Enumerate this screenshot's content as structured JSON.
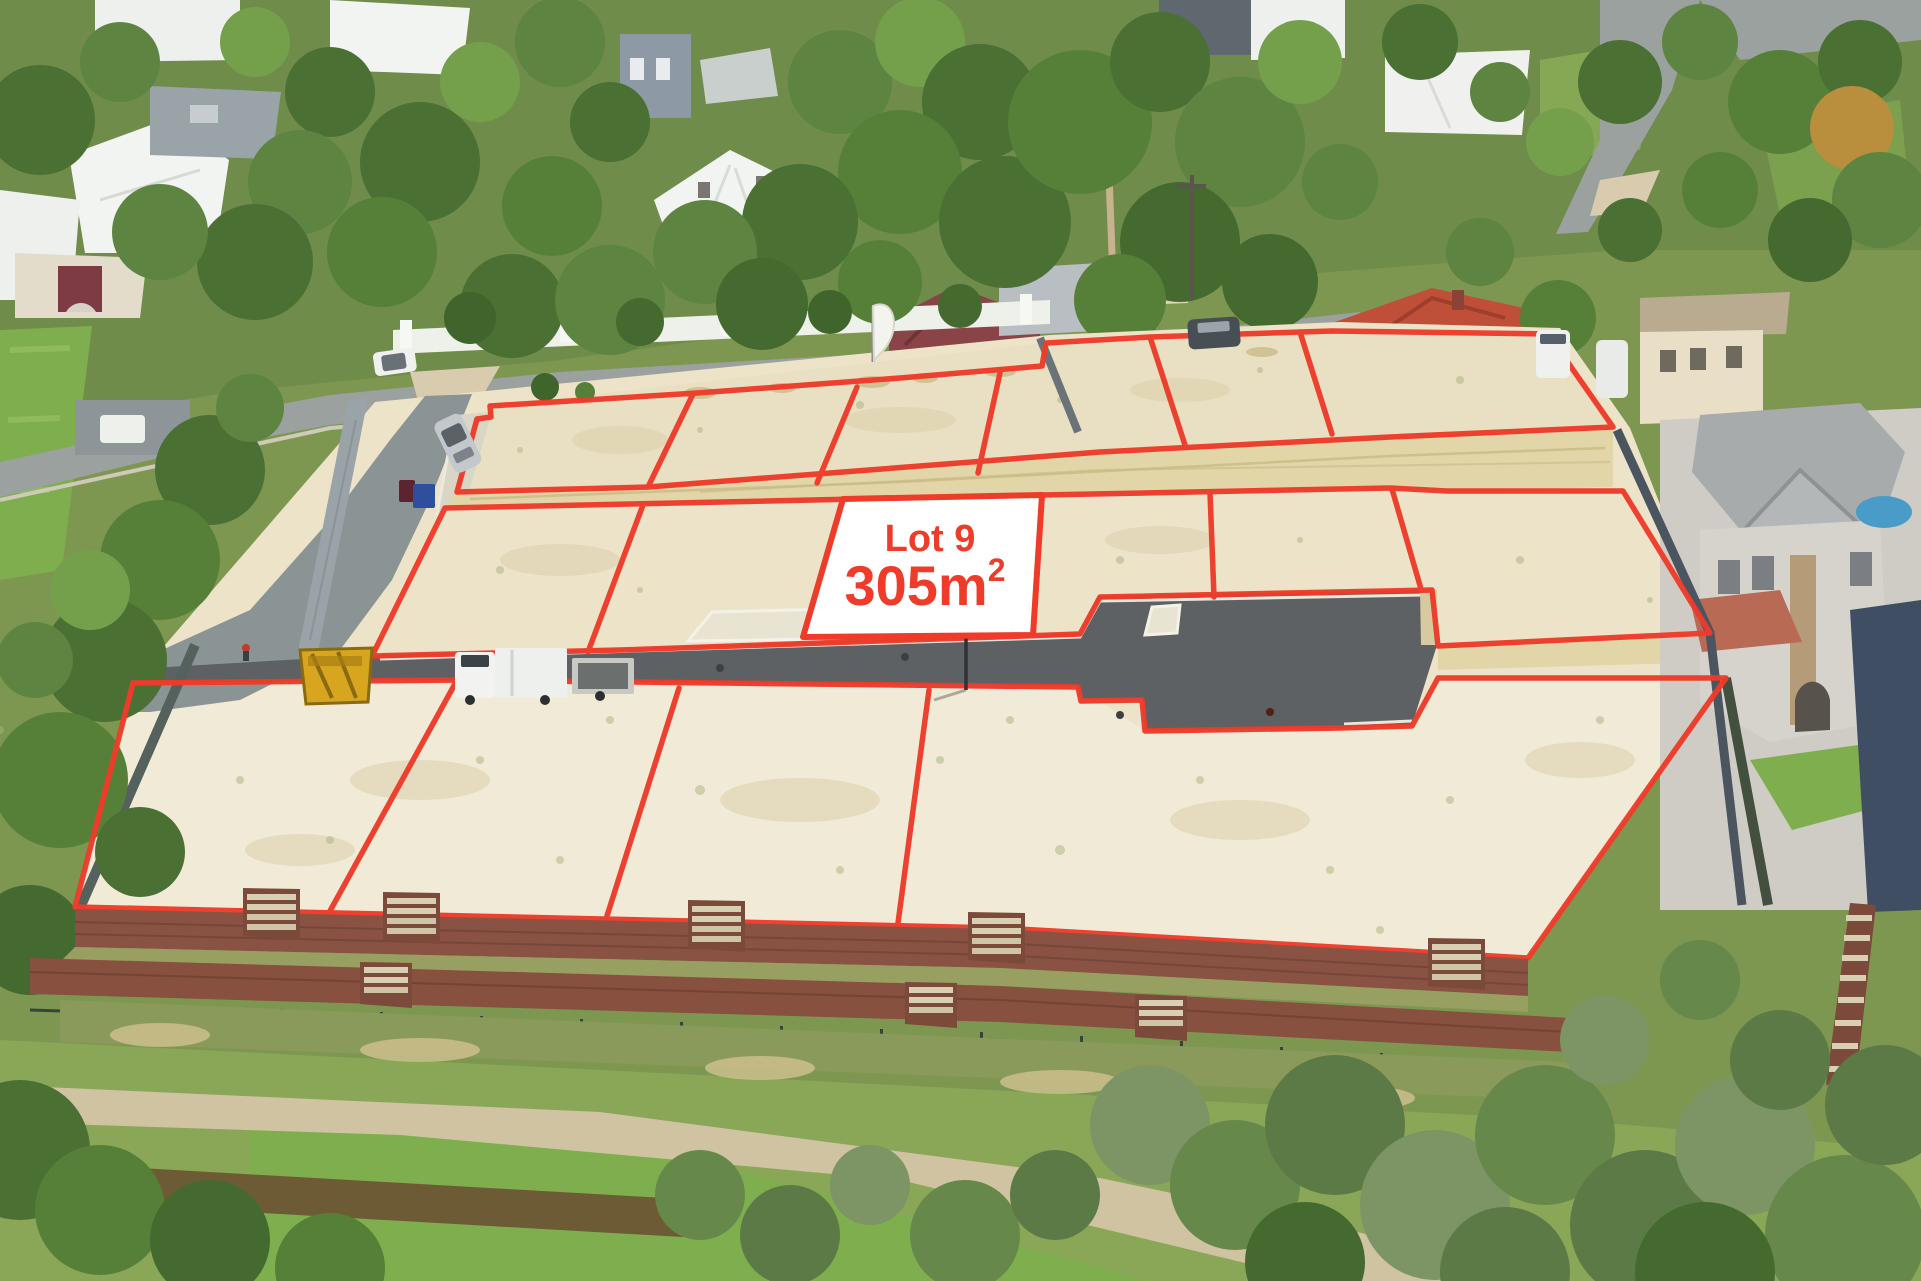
{
  "photo": {
    "description": "aerial-drone-photo-of-cleared-land-estate-with-red-lot-outlines",
    "width": 1921,
    "height": 1281
  },
  "lot_label": {
    "name": "Lot 9",
    "area_value": "305m",
    "area_superscript": "2"
  },
  "colors": {
    "boundary_red": "#ee3b2a",
    "label_background": "#ffffff",
    "label_text": "#ee3b2a",
    "sand": "#ece3c9",
    "sand_front": "#f1ead8",
    "new_street_asphalt": "#5d6163",
    "old_road_asphalt": "#9aa09d",
    "kerb_white": "#e9e6da",
    "limestone_wall": "#e2d5a7",
    "brick_wall": "#8a5243",
    "tree_green": "#5d8440",
    "roof_red_tile": "#bf4f38",
    "roof_white": "#f2f4f2"
  }
}
